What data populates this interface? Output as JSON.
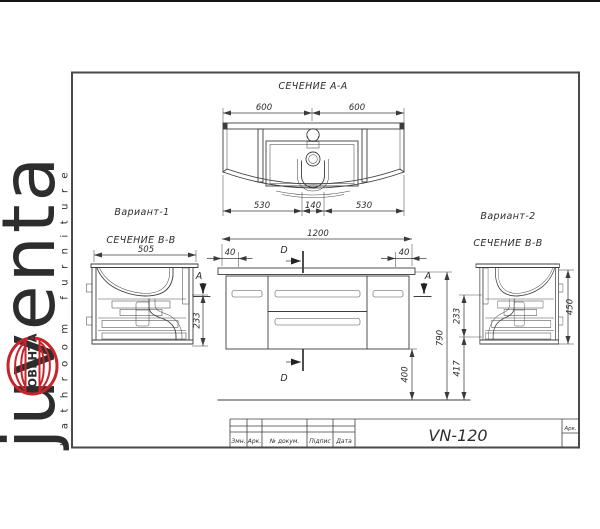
{
  "brand": {
    "name": "juventa",
    "tagline": "bathroom furniture",
    "emblem_text": "ЮВЕНТА",
    "brand_color": "#c9242b",
    "tagline_color": "#9b9b9b"
  },
  "sections": {
    "aa_title": "СЕЧЕНИЕ А-А",
    "variant1_label": "Вариант-1",
    "variant1_section": "СЕЧЕНИЕ В-В",
    "variant2_label": "Вариант-2",
    "variant2_section": "СЕЧЕНИЕ В-В"
  },
  "dims": {
    "aa_top_left": "600",
    "aa_top_right": "600",
    "aa_bot_left": "530",
    "aa_bot_center": "140",
    "aa_bot_right": "530",
    "v1_depth": "505",
    "v1_height": "233",
    "front_width": "1200",
    "front_gap_left": "40",
    "front_gap_right": "40",
    "front_bottom_clearance": "400",
    "front_total_height": "790",
    "v2_upper": "233",
    "v2_lower": "417",
    "v2_height": "450"
  },
  "marks": {
    "d_top": "D",
    "d_bottom": "D",
    "a_left": "A",
    "a_right": "A"
  },
  "title_block": {
    "model": "VN-120",
    "col_change": "Змн.",
    "col_sheet": "Арк.",
    "col_doc": "№ докум.",
    "col_sign": "Підпис",
    "col_date": "Дата",
    "sheet_label": "Арк."
  },
  "colors": {
    "line": "#3d3d3d",
    "frame": "#4a4a4a"
  }
}
